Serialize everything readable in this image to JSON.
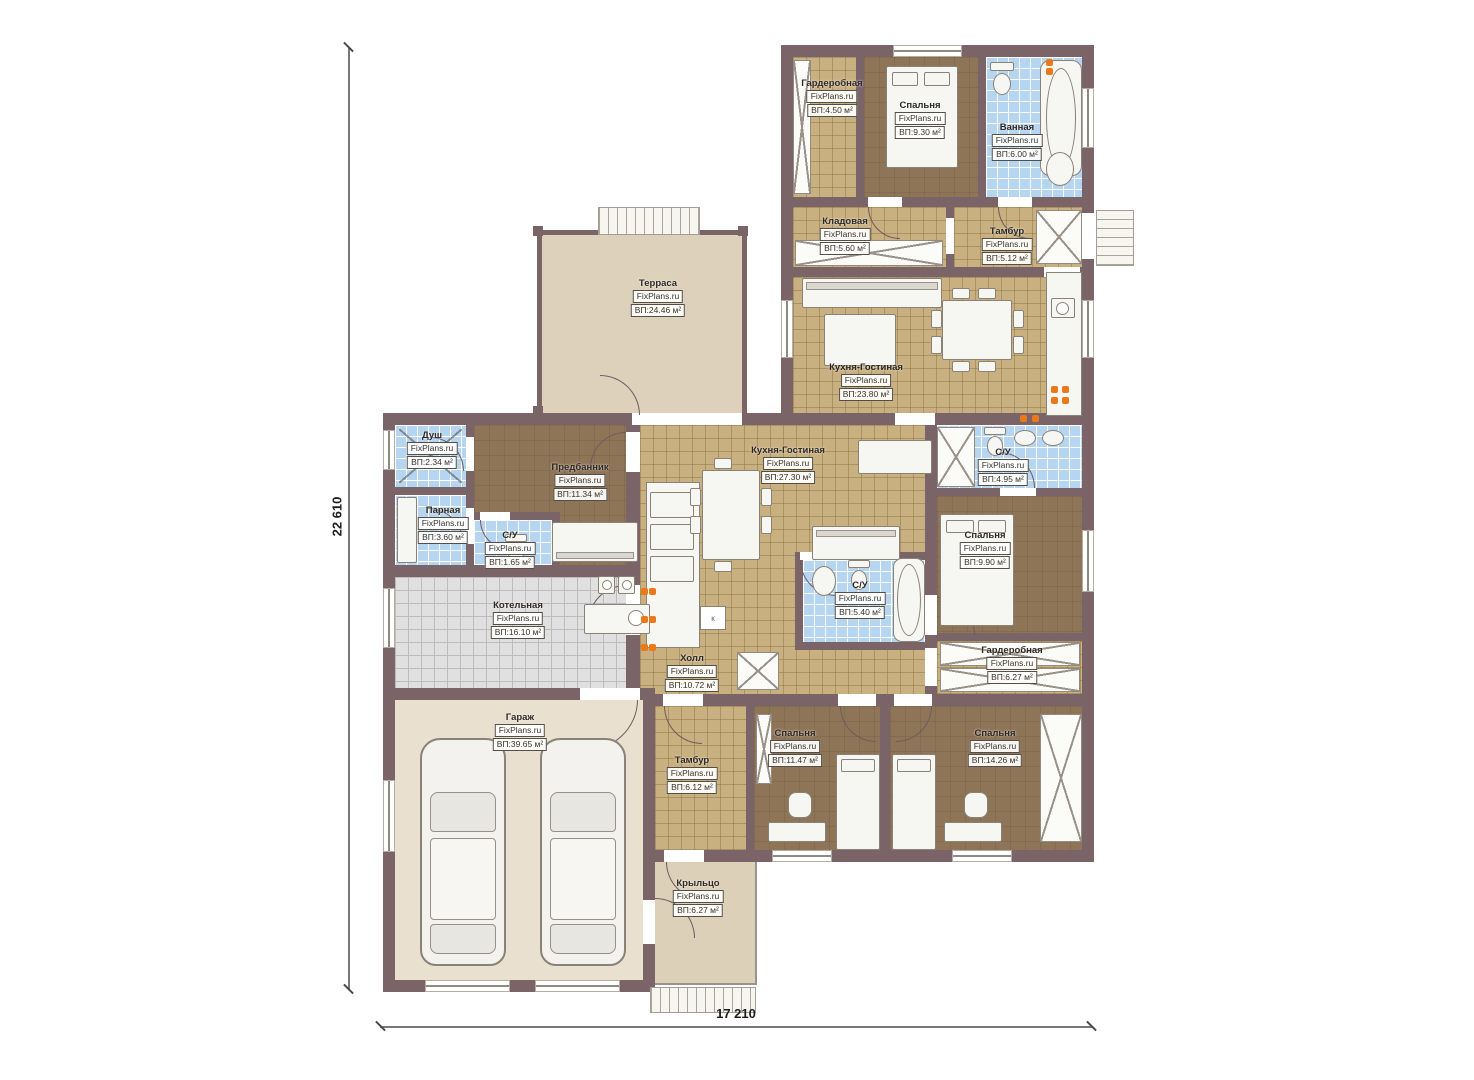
{
  "watermark": "FixPlans.ru",
  "dimensions": {
    "height_mm": "22 610",
    "width_mm": "17 210"
  },
  "misc": {
    "shaft_label": "к"
  },
  "colors": {
    "wall": "#7a6468",
    "tile_tan": "#c9b080",
    "tile_blue": "#b5d5f0",
    "tile_gray": "#e0e0e0",
    "floor_brown": "#8e7557",
    "terrace": "#ddd1bc",
    "garage": "#eae0d0",
    "accent_orange": "#e9791b"
  },
  "rooms": [
    {
      "name": "Гардеробная",
      "area": "ВП:4.50 м²"
    },
    {
      "name": "Спальня",
      "area": "ВП:9.30 м²"
    },
    {
      "name": "Ванная",
      "area": "ВП:6.00 м²"
    },
    {
      "name": "Кладовая",
      "area": "ВП:5.60 м²"
    },
    {
      "name": "Тамбур",
      "area": "ВП:5.12 м²"
    },
    {
      "name": "Терраса",
      "area": "ВП:24.46 м²"
    },
    {
      "name": "Кухня-Гостиная",
      "area": "ВП:23.80 м²"
    },
    {
      "name": "Душ",
      "area": "ВП:2.34 м²"
    },
    {
      "name": "Предбанник",
      "area": "ВП:11.34 м²"
    },
    {
      "name": "Парная",
      "area": "ВП:3.60 м²"
    },
    {
      "name": "С/У",
      "area": "ВП:1.65 м²"
    },
    {
      "name": "Кухня-Гостиная",
      "area": "ВП:27.30 м²"
    },
    {
      "name": "С/У",
      "area": "ВП:4.95 м²"
    },
    {
      "name": "Спальня",
      "area": "ВП:9.90 м²"
    },
    {
      "name": "С/У",
      "area": "ВП:5.40 м²"
    },
    {
      "name": "Котельная",
      "area": "ВП:16.10 м²"
    },
    {
      "name": "Холл",
      "area": "ВП:10.72 м²"
    },
    {
      "name": "Гардеробная",
      "area": "ВП:6.27 м²"
    },
    {
      "name": "Гараж",
      "area": "ВП:39.65 м²"
    },
    {
      "name": "Тамбур",
      "area": "ВП:6.12 м²"
    },
    {
      "name": "Спальня",
      "area": "ВП:11.47 м²"
    },
    {
      "name": "Спальня",
      "area": "ВП:14.26 м²"
    },
    {
      "name": "Крыльцо",
      "area": "ВП:6.27 м²"
    }
  ]
}
